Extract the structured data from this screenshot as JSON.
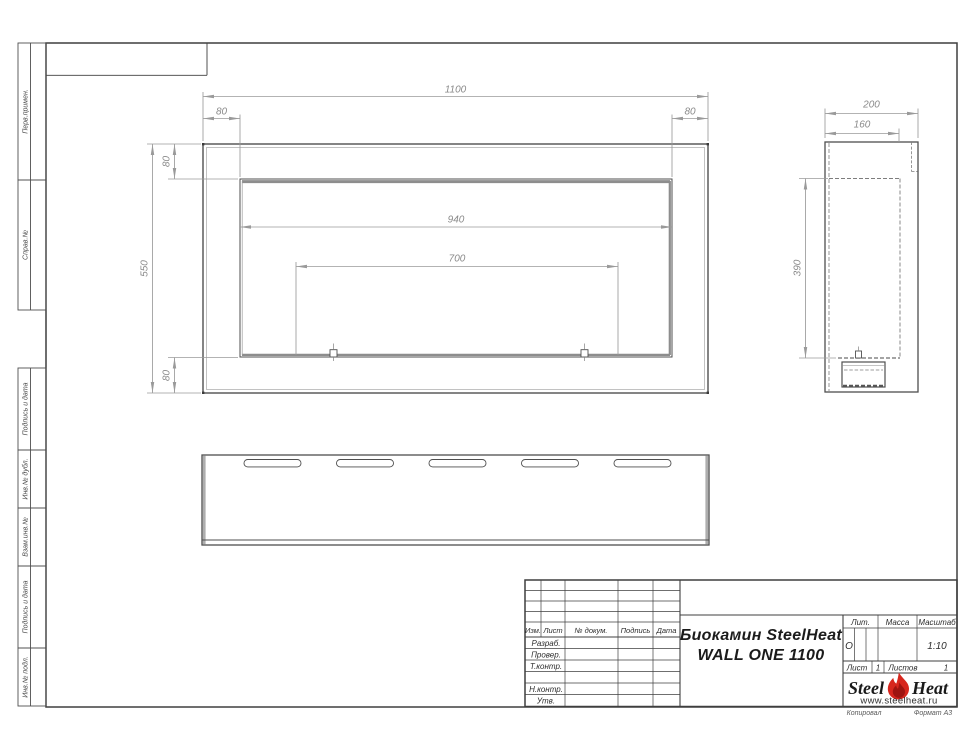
{
  "frame": {
    "margin_boxes": [
      {
        "label": "Перв.примен."
      },
      {
        "label": "Справ.№"
      },
      {
        "label": "Подпись и дата"
      },
      {
        "label": "Инв.№ дубл."
      },
      {
        "label": "Взам.инв.№"
      },
      {
        "label": "Подпись и дата"
      },
      {
        "label": "Инв.№ подл."
      }
    ]
  },
  "dims": {
    "front_width": "1100",
    "front_inset_left": "80",
    "front_inset_right": "80",
    "front_height": "550",
    "front_top_offset": "80",
    "front_bottom_offset": "80",
    "opening_width": "940",
    "burner_width": "700",
    "side_depth": "200",
    "side_inner_depth": "160",
    "side_opening_height": "390"
  },
  "title_block": {
    "revision_header": {
      "izm": "Изм.",
      "list": "Лист",
      "doc": "№ докум.",
      "sign": "Подпись",
      "date": "Дата"
    },
    "rows": [
      {
        "label": "Разраб."
      },
      {
        "label": "Провер."
      },
      {
        "label": "Т.контр."
      },
      {
        "label": ""
      },
      {
        "label": "Н.контр."
      },
      {
        "label": "Утв."
      }
    ],
    "doc_title_line1": "Биокамин SteelHeat",
    "doc_title_line2": "WALL ONE 1100",
    "lit_label": "Лит.",
    "lit_value": "О",
    "mass_label": "Масса",
    "scale_label": "Масштаб",
    "scale_value": "1:10",
    "sheet_label": "Лист",
    "sheet_value": "1",
    "sheets_label": "Листов",
    "sheets_value": "1",
    "logo_steel": "Steel",
    "logo_heat": "Heat",
    "logo_site": "www.steelheat.ru",
    "footer_left": "Копировал",
    "footer_right": "Формат А3"
  },
  "colors": {
    "line": "#4f4f4f",
    "dim": "#9a9a9a",
    "flame": "#d7261d"
  }
}
